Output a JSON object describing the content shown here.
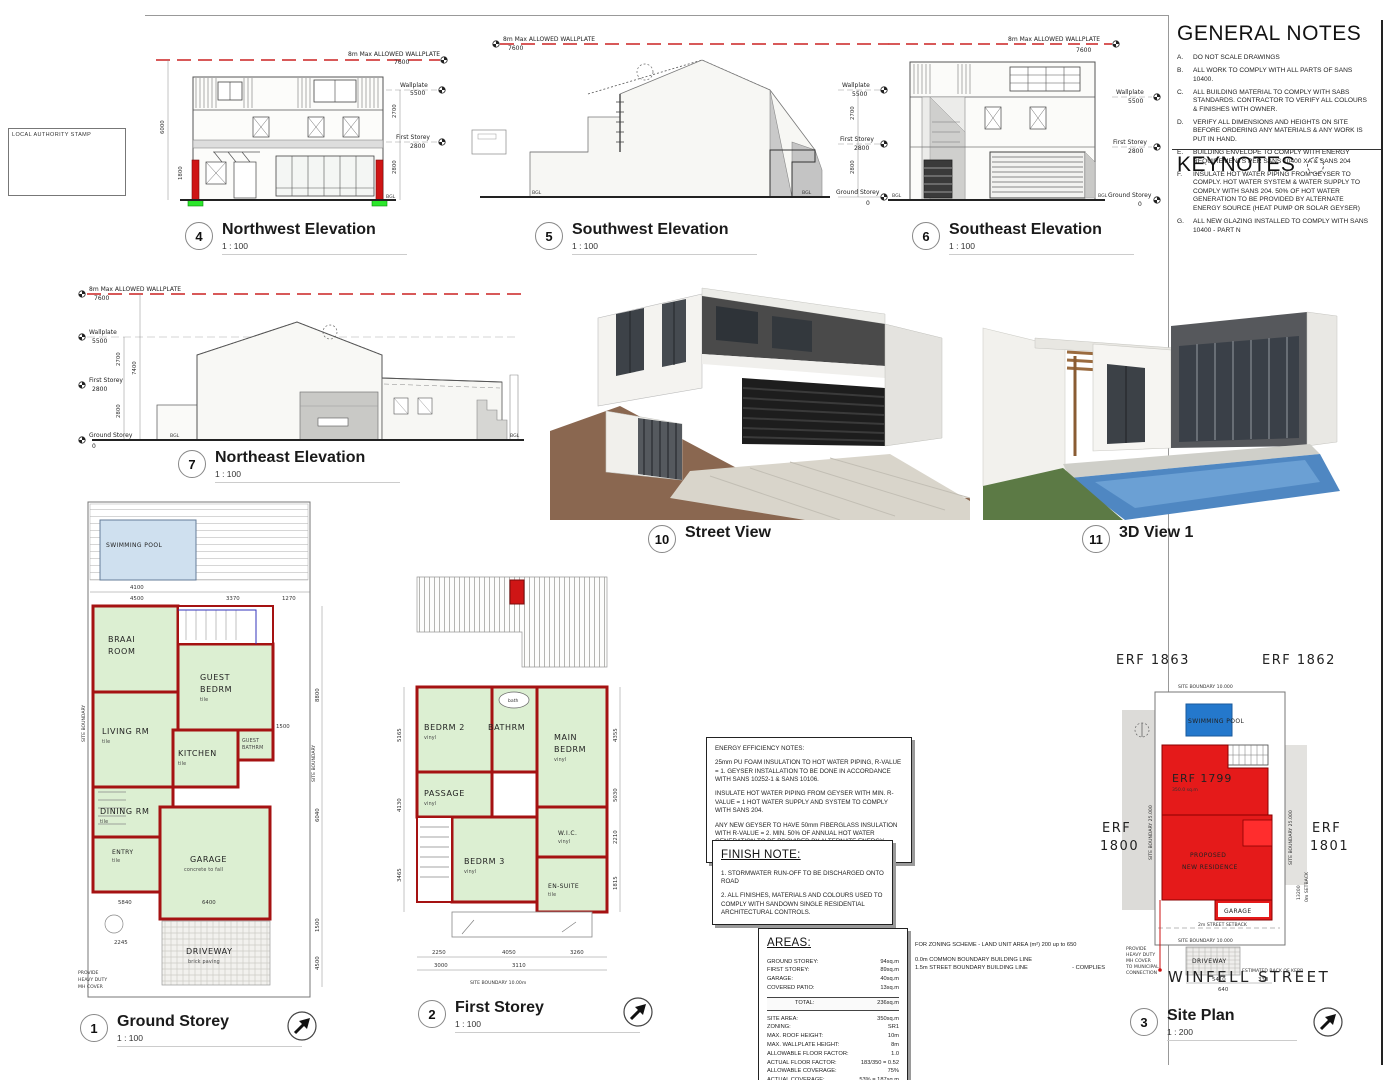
{
  "sheet": {
    "stamp_label": "LOCAL AUTHORITY STAMP"
  },
  "general_notes": {
    "title": "GENERAL NOTES",
    "items": [
      {
        "key": "A.",
        "text": "DO NOT SCALE DRAWINGS"
      },
      {
        "key": "B.",
        "text": "ALL WORK TO COMPLY WITH ALL PARTS OF SANS 10400."
      },
      {
        "key": "C.",
        "text": "ALL BUILDING MATERIAL TO COMPLY WITH SABS STANDARDS. CONTRACTOR TO VERIFY ALL COLOURS & FINISHES WITH OWNER."
      },
      {
        "key": "D.",
        "text": "VERIFY ALL DIMENSIONS AND HEIGHTS ON SITE BEFORE ORDERING ANY MATERIALS & ANY WORK IS PUT IN HAND."
      },
      {
        "key": "E.",
        "text": "BUILDING ENVELOPE TO COMPLY WITH ENERGY REQUIREMENTS PER SANS 10400 XA & SANS 204"
      },
      {
        "key": "F.",
        "text": "INSULATE HOT WATER PIPING FROM GEYSER TO COMPLY. HOT WATER SYSTEM & WATER SUPPLY TO COMPLY WITH SANS 204. 50% OF HOT WATER GENERATION TO BE PROVIDED BY ALTERNATE ENERGY SOURCE (HEAT PUMP OR SOLAR GEYSER)"
      },
      {
        "key": "G.",
        "text": "ALL NEW GLAZING INSTALLED TO COMPLY WITH SANS 10400 - PART N"
      }
    ]
  },
  "keynotes": {
    "title": "KEYNOTES"
  },
  "viewports": {
    "v1": {
      "num": "1",
      "title": "Ground Storey",
      "scale": "1 : 100"
    },
    "v2": {
      "num": "2",
      "title": "First Storey",
      "scale": "1 : 100"
    },
    "v3": {
      "num": "3",
      "title": "Site Plan",
      "scale": "1 : 200"
    },
    "v4": {
      "num": "4",
      "title": "Northwest Elevation",
      "scale": "1 : 100"
    },
    "v5": {
      "num": "5",
      "title": "Southwest Elevation",
      "scale": "1 : 100"
    },
    "v6": {
      "num": "6",
      "title": "Southeast Elevation",
      "scale": "1 : 100"
    },
    "v7": {
      "num": "7",
      "title": "Northeast Elevation",
      "scale": "1 : 100"
    },
    "v10": {
      "num": "10",
      "title": "Street View"
    },
    "v11": {
      "num": "11",
      "title": "3D View 1"
    }
  },
  "elev": {
    "max_wallplate_label": "8m Max ALLOWED WALLPLATE",
    "max_wallplate_val": "7600",
    "wallplate_label": "Wallplate",
    "wallplate_val": "5500",
    "first_label": "First Storey",
    "first_val": "2800",
    "ground_label": "Ground Storey",
    "ground_val": "0",
    "d2700": "2700",
    "d2800": "2800",
    "d6000": "6000",
    "d1800": "1800",
    "d7400": "7400",
    "bgl": "BGL"
  },
  "ground_plan": {
    "pool": "SWIMMING POOL",
    "braai1": "BRAAI",
    "braai2": "ROOM",
    "guest1": "GUEST",
    "guest2": "BEDRM",
    "living": "LIVING RM",
    "gbath1": "GUEST",
    "gbath2": "BATHRM",
    "kitchen": "KITCHEN",
    "dining": "DINING RM",
    "entry": "ENTRY",
    "garage": "GARAGE",
    "garage_fin": "concrete to fall",
    "driveway": "DRIVEWAY",
    "driveway_fin": "brick paving",
    "tile": "tile",
    "boundary": "SITE BOUNDARY",
    "mh_note1": "PROVIDE",
    "mh_note2": "HEAVY DUTY",
    "mh_note3": "MH COVER",
    "d4500": "4500",
    "d3370": "3370",
    "d1270": "1270",
    "d4100": "4100",
    "d5840": "5840",
    "d6400": "6400",
    "d8800": "8800",
    "d6040": "6040",
    "d1500": "1500",
    "d4500b": "4500",
    "d2245": "2245"
  },
  "first_plan": {
    "bedrm2": "BEDRM 2",
    "bathrm": "BATHRM",
    "bath": "bath",
    "main1": "MAIN",
    "main2": "BEDRM",
    "passage": "PASSAGE",
    "bedrm3": "BEDRM 3",
    "wic": "W.I.C.",
    "ensuite": "EN-SUITE",
    "vinyl": "vinyl",
    "tile": "tile",
    "boundary": "SITE BOUNDARY 10.00m",
    "d2250": "2250",
    "d4050": "4050",
    "d3260": "3260",
    "d3000": "3000",
    "d3110": "3110",
    "d5165": "5165",
    "d4130": "4130",
    "d3465": "3465",
    "d4355": "4355",
    "d5030": "5030",
    "d2210": "2210",
    "d1815": "1815"
  },
  "notes_energy": {
    "title": "ENERGY EFFICIENCY NOTES:",
    "p1": "25mm PU FOAM INSULATION TO HOT WATER PIPING, R-VALUE = 1. GEYSER INSTALLATION TO BE DONE IN ACCORDANCE WITH SANS 10252-1 & SANS 10106.",
    "p2": "INSULATE HOT WATER PIPING FROM GEYSER WITH MIN. R-VALUE = 1 HOT WATER SUPPLY AND SYSTEM TO COMPLY WITH SANS 204.",
    "p3": "ANY NEW GEYSER TO HAVE 50mm FIBERGLASS INSULATION WITH R-VALUE = 2. MIN. 50% OF ANNUAL HOT WATER GENERATION TO BE PROVIDED BY ALTERNATE ENERGY SOURCE."
  },
  "finish_note": {
    "title": "FINISH NOTE:",
    "item1": "1. STORMWATER RUN-OFF TO BE DISCHARGED ONTO ROAD",
    "item2": "2. ALL FINISHES, MATERIALS AND COLOURS USED TO COMPLY WITH SANDOWN SINGLE RESIDENTIAL ARCHITECTURAL CONTROLS."
  },
  "areas": {
    "title": "AREAS:",
    "rows": [
      {
        "label": "GROUND STOREY:",
        "value": "94sq.m"
      },
      {
        "label": "FIRST STOREY:",
        "value": "89sq.m"
      },
      {
        "label": "GARAGE:",
        "value": "40sq.m"
      },
      {
        "label": "COVERED PATIO:",
        "value": "13sq.m"
      }
    ],
    "total_label": "TOTAL:",
    "total_value": "236sq.m",
    "site_rows": [
      {
        "label": "SITE AREA:",
        "value": "350sq.m"
      },
      {
        "label": "ZONING:",
        "value": "SR1"
      },
      {
        "label": "MAX. ROOF HEIGHT:",
        "value": "10m"
      },
      {
        "label": "MAX. WALLPLATE HEIGHT:",
        "value": "8m"
      },
      {
        "label": "ALLOWABLE FLOOR FACTOR:",
        "value": "1.0"
      },
      {
        "label": "ACTUAL FLOOR FACTOR:",
        "value": "183/350 = 0.52"
      },
      {
        "label": "ALLOWABLE COVERAGE:",
        "value": "75%"
      },
      {
        "label": "ACTUAL COVERAGE:",
        "value": "53% = 187sq.m"
      }
    ]
  },
  "zoning_note": {
    "line1": "FOR ZONING SCHEME - LAND UNIT AREA (m²) 200 up to 650",
    "line2": "0.0m COMMON BOUNDARY BUILDING LINE",
    "line3": "1.5m STREET BOUNDARY BUILDING LINE",
    "complies": "- COMPLIES"
  },
  "site_plan": {
    "erf_1863": "ERF 1863",
    "erf_1862": "ERF 1862",
    "erf_1800a": "ERF",
    "erf_1800b": "1800",
    "erf_1801a": "ERF",
    "erf_1801b": "1801",
    "erf_main": "ERF 1799",
    "erf_main_area": "350.0 sq.m",
    "pool": "SWIMMING POOL",
    "residence1": "PROPOSED",
    "residence2": "NEW RESIDENCE",
    "garage": "GARAGE",
    "driveway": "DRIVEWAY",
    "street": "WINFELL STREET",
    "boundary_top": "SITE BOUNDARY 10.000",
    "boundary_bottom": "SITE BOUNDARY 10.000",
    "boundary_left": "SITE BOUNDARY 25.000",
    "boundary_right": "SITE BOUNDARY 25.000",
    "setback_street": "2m STREET SETBACK",
    "setback_side": "0m SETBACK",
    "kerb": "ESTIMATED BACK OF KERB",
    "mh1": "PROVIDE",
    "mh2": "HEAVY DUTY",
    "mh3": "MH COVER",
    "mh4": "TO MUNICIPAL",
    "mh5": "CONNECTION",
    "d13200": "13200",
    "d5410": "5410",
    "d330": "330",
    "d640": "640"
  },
  "colors": {
    "wall_red": "#a51212",
    "bright_red": "#e51a1a",
    "room_green": "#dcefd2",
    "pad_green": "#2be62b",
    "pool_plan": "#cfe0ef",
    "pool_site": "#2478cc",
    "dashed_red": "#cc2222",
    "render_dark": "#4a4a4a",
    "ground_brown": "#8a6750"
  }
}
